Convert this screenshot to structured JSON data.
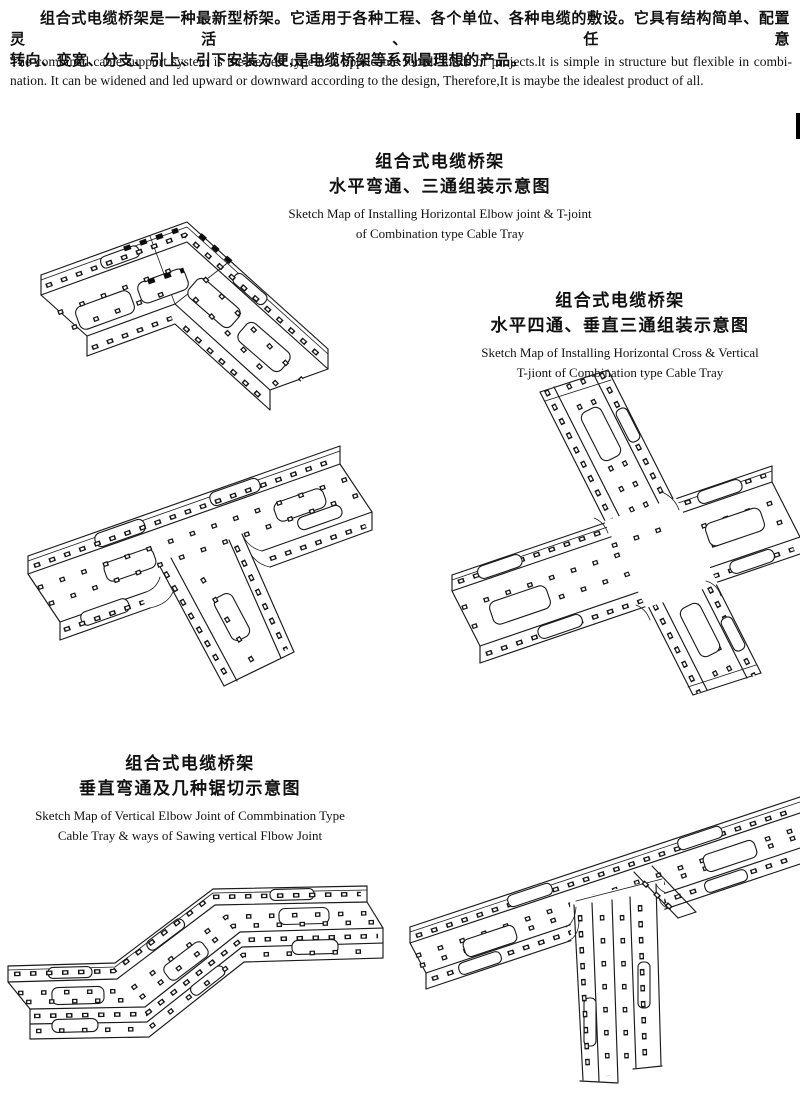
{
  "intro": {
    "zh_line1": "组合式电缆桥架是一种最新型桥架。它适用于各种工程、各个单位、各种电缆的敷设。它具有结构简单、配置灵活、任意",
    "zh_line2": "转向、变宽、分支、引上、引下安装方便,是电缆桥架等系列最理想的产品。",
    "en_line1": "The combined cable support system is the newest type.It is applicable for all kinds of projects.lt is simple in structure but flexible in combi-",
    "en_line2": "nation. It can be widened and led upward or downward according to the design, Therefore,It is maybe the idealest product of all."
  },
  "figures": [
    {
      "zh1": "组合式电缆桥架",
      "zh2": "水平弯通、三通组装示意图",
      "en1": "Sketch Map of Installing Horizontal Elbow joint & T-joint",
      "en2": "of Combination type Cable Tray"
    },
    {
      "zh1": "组合式电缆桥架",
      "zh2": "水平四通、垂直三通组装示意图",
      "en1": "Sketch Map of Installing Horizontal Cross & Vertical",
      "en2": "T-jiont of Combination type Cable Tray"
    },
    {
      "zh1": "组合式电缆桥架",
      "zh2": "垂直弯通及几种锯切示意图",
      "en1": "Sketch Map of Vertical Elbow Joint of Commbination Type",
      "en2": "Cable Tray & ways of Sawing vertical Flbow Joint"
    }
  ],
  "colors": {
    "ink": "#1a1a1a",
    "paper": "#ffffff"
  }
}
